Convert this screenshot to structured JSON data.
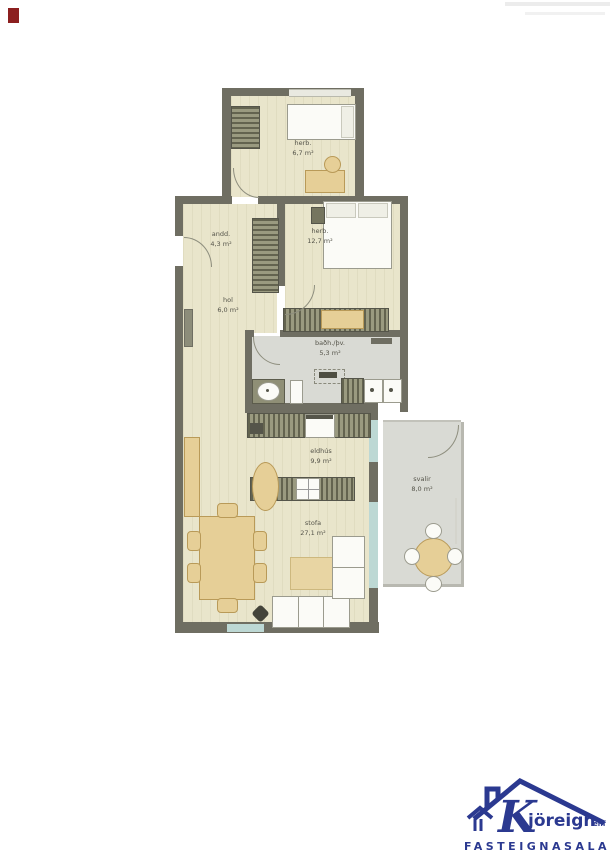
{
  "document": {
    "type": "real-estate-floor-plan",
    "language": "Icelandic"
  },
  "rooms": [
    {
      "id": "herb-small",
      "name": "herb.",
      "area": "6,7 m²"
    },
    {
      "id": "anddyri",
      "name": "andd.",
      "area": "4,3 m²"
    },
    {
      "id": "svefnherbergi",
      "name": "herb.",
      "area": "12,7 m²"
    },
    {
      "id": "hol",
      "name": "hol",
      "area": "6,0 m²"
    },
    {
      "id": "badherbergi",
      "name": "baðh./þv.",
      "area": "5,3 m²"
    },
    {
      "id": "eldhus",
      "name": "eldhús",
      "area": "9,9 m²"
    },
    {
      "id": "stofa",
      "name": "stofa",
      "area": "27,1 m²"
    },
    {
      "id": "svalir",
      "name": "svalir",
      "area": "8,0 m²"
    }
  ],
  "logo": {
    "brand_initial": "K",
    "brand_rest": "jöreign",
    "brand_suffix": "ehf",
    "tagline": "FASTEIGNASALA",
    "color": "#2b3990"
  },
  "colors": {
    "wall": "#6f6e62",
    "wood_floor": "#e9e5cb",
    "tile_floor": "#d9dad4",
    "furniture_tan": "#e6cf97",
    "glass": "#bdd8d4",
    "logo_blue": "#2b3990",
    "red_mark": "#8c1f1f"
  }
}
